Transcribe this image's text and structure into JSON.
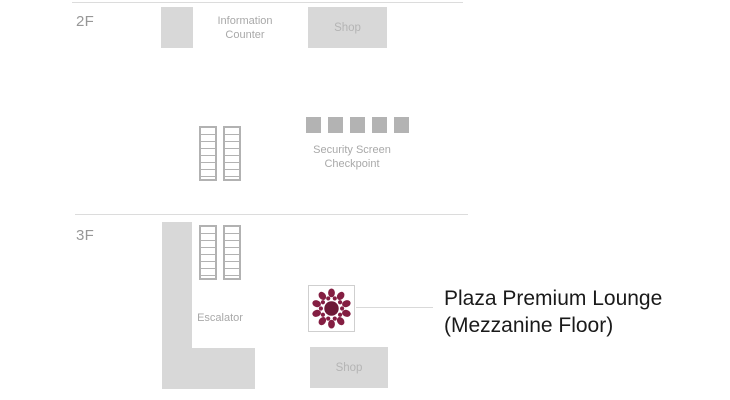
{
  "colors": {
    "brand_maroon": "#841E42",
    "brand_maroon_dark": "#6D1A37",
    "block_gray": "#D8D8D8",
    "label_gray": "#A9A9A9",
    "text_black": "#1A1A1A"
  },
  "floor2": {
    "label": "2F",
    "information_counter": "Information Counter",
    "shop": "Shop",
    "security_checkpoint": "Security Screen Checkpoint"
  },
  "floor3": {
    "label": "3F",
    "escalator": "Escalator",
    "shop": "Shop",
    "lounge_line1": "Plaza Premium Lounge",
    "lounge_line2": "(Mezzanine Floor)"
  }
}
